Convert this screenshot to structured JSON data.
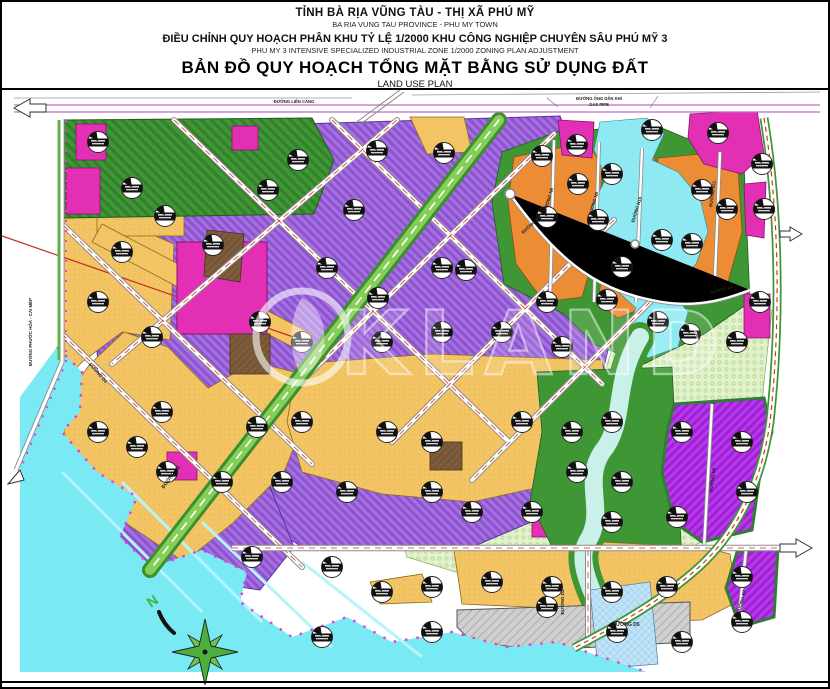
{
  "title_block": {
    "province_vi": "TỈNH BÀ RỊA VŨNG TÀU - THỊ XÃ PHÚ MỸ",
    "province_en": "BA RIA VUNG TAU PROVINCE - PHU MY TOWN",
    "project_vi": "ĐIỀU CHỈNH QUY HOẠCH PHÂN KHU TỶ LỆ 1/2000 KHU CÔNG NGHIỆP CHUYÊN SÂU PHÚ MỸ 3",
    "project_en": "PHU MY 3 INTENSIVE SPECIALIZED INDUSTRIAL ZONE 1/2000 ZONING PLAN ADJUSTMENT",
    "map_title_vi": "BẢN ĐỒ QUY HOẠCH TỔNG MẶT BẰNG SỬ DỤNG ĐẤT",
    "map_title_en": "LAND USE PLAN"
  },
  "map": {
    "watermark": "KLAND",
    "compass_label": "N",
    "colors": {
      "industrial_purple": "#A472E0",
      "industrial_bright_purple": "#B43BE8",
      "commercial_orange": "#EC8C35",
      "mixed_yellow": "#F2C464",
      "service_magenta": "#E22FB4",
      "green_space": "#3E9635",
      "boulevard_green": "#85CE58",
      "water_cyan": "#79E9F4",
      "river_pale": "#C9F1EA",
      "reserve_pale_green": "#E2F3CB",
      "road_gray": "#CFCFCF",
      "technical_brown": "#7D5C3C",
      "utility_blue": "#BFE3F7",
      "boundary_pink": "#E33FD6"
    },
    "road_labels": [
      {
        "t": "ĐƯỜNG LIÊN CẢNG",
        "x": 292,
        "y": 101,
        "r": 0,
        "s": 4.2
      },
      {
        "t": "ĐƯỜNG ỐNG DẪN KHÍ",
        "x": 597,
        "y": 98,
        "r": 0,
        "s": 4.2
      },
      {
        "t": "GAS PIPE",
        "x": 597,
        "y": 104,
        "r": 0,
        "s": 4.2
      },
      {
        "t": "ĐƯỜNG PHƯỚC HÒA - CÁI MÉP",
        "x": 30,
        "y": 330,
        "r": -90,
        "s": 4.4
      },
      {
        "t": "ĐƯỜNG N2",
        "x": 170,
        "y": 476,
        "r": -53,
        "s": 5
      },
      {
        "t": "ĐƯỜNG D4",
        "x": 95,
        "y": 372,
        "r": 49,
        "s": 4.6
      },
      {
        "t": "ĐƯỜNG N8",
        "x": 548,
        "y": 198,
        "r": -73,
        "s": 4.4
      },
      {
        "t": "ĐƯỜNG N9",
        "x": 593,
        "y": 202,
        "r": -73,
        "s": 4.4
      },
      {
        "t": "ĐƯỜNG N10",
        "x": 636,
        "y": 208,
        "r": -73,
        "s": 4.4
      },
      {
        "t": "ĐƯỜNG N11",
        "x": 712,
        "y": 192,
        "r": -82,
        "s": 4.4
      },
      {
        "t": "ĐƯỜNG D6",
        "x": 530,
        "y": 224,
        "r": -42,
        "s": 4.4
      },
      {
        "t": "ĐƯỜNG D6",
        "x": 720,
        "y": 289,
        "r": -16,
        "s": 4.4
      },
      {
        "t": "ĐƯỜNG D2",
        "x": 562,
        "y": 600,
        "r": -90,
        "s": 4.6
      },
      {
        "t": "ĐƯỜNG D5",
        "x": 624,
        "y": 624,
        "r": 0,
        "s": 5
      },
      {
        "t": "ĐƯỜNG N6",
        "x": 712,
        "y": 478,
        "r": -82,
        "s": 4.4
      },
      {
        "t": "ĐƯỜNG N7",
        "x": 741,
        "y": 600,
        "r": -76,
        "s": 4.4
      }
    ],
    "parcel_markers": [
      [
        96,
        140
      ],
      [
        130,
        186
      ],
      [
        163,
        214
      ],
      [
        211,
        243
      ],
      [
        266,
        188
      ],
      [
        296,
        158
      ],
      [
        352,
        208
      ],
      [
        375,
        149
      ],
      [
        442,
        151
      ],
      [
        540,
        154
      ],
      [
        575,
        143
      ],
      [
        610,
        172
      ],
      [
        650,
        128
      ],
      [
        716,
        131
      ],
      [
        760,
        162
      ],
      [
        700,
        188
      ],
      [
        725,
        207
      ],
      [
        762,
        207
      ],
      [
        545,
        215
      ],
      [
        596,
        218
      ],
      [
        660,
        238
      ],
      [
        690,
        242
      ],
      [
        620,
        265
      ],
      [
        576,
        182
      ],
      [
        325,
        266
      ],
      [
        376,
        296
      ],
      [
        440,
        266
      ],
      [
        464,
        268
      ],
      [
        545,
        300
      ],
      [
        605,
        298
      ],
      [
        656,
        320
      ],
      [
        688,
        332
      ],
      [
        735,
        340
      ],
      [
        758,
        300
      ],
      [
        120,
        250
      ],
      [
        96,
        300
      ],
      [
        150,
        335
      ],
      [
        258,
        320
      ],
      [
        300,
        340
      ],
      [
        380,
        340
      ],
      [
        440,
        330
      ],
      [
        500,
        330
      ],
      [
        560,
        345
      ],
      [
        160,
        410
      ],
      [
        96,
        430
      ],
      [
        135,
        445
      ],
      [
        255,
        425
      ],
      [
        300,
        420
      ],
      [
        385,
        430
      ],
      [
        430,
        440
      ],
      [
        520,
        420
      ],
      [
        570,
        430
      ],
      [
        610,
        420
      ],
      [
        680,
        430
      ],
      [
        740,
        440
      ],
      [
        575,
        470
      ],
      [
        620,
        480
      ],
      [
        165,
        470
      ],
      [
        220,
        480
      ],
      [
        280,
        480
      ],
      [
        345,
        490
      ],
      [
        430,
        490
      ],
      [
        470,
        510
      ],
      [
        530,
        510
      ],
      [
        610,
        520
      ],
      [
        675,
        515
      ],
      [
        745,
        490
      ],
      [
        250,
        555
      ],
      [
        330,
        565
      ],
      [
        380,
        590
      ],
      [
        430,
        585
      ],
      [
        490,
        580
      ],
      [
        550,
        585
      ],
      [
        610,
        590
      ],
      [
        665,
        585
      ],
      [
        740,
        575
      ],
      [
        740,
        620
      ],
      [
        320,
        635
      ],
      [
        430,
        630
      ],
      [
        545,
        605
      ],
      [
        615,
        630
      ],
      [
        680,
        640
      ]
    ]
  }
}
